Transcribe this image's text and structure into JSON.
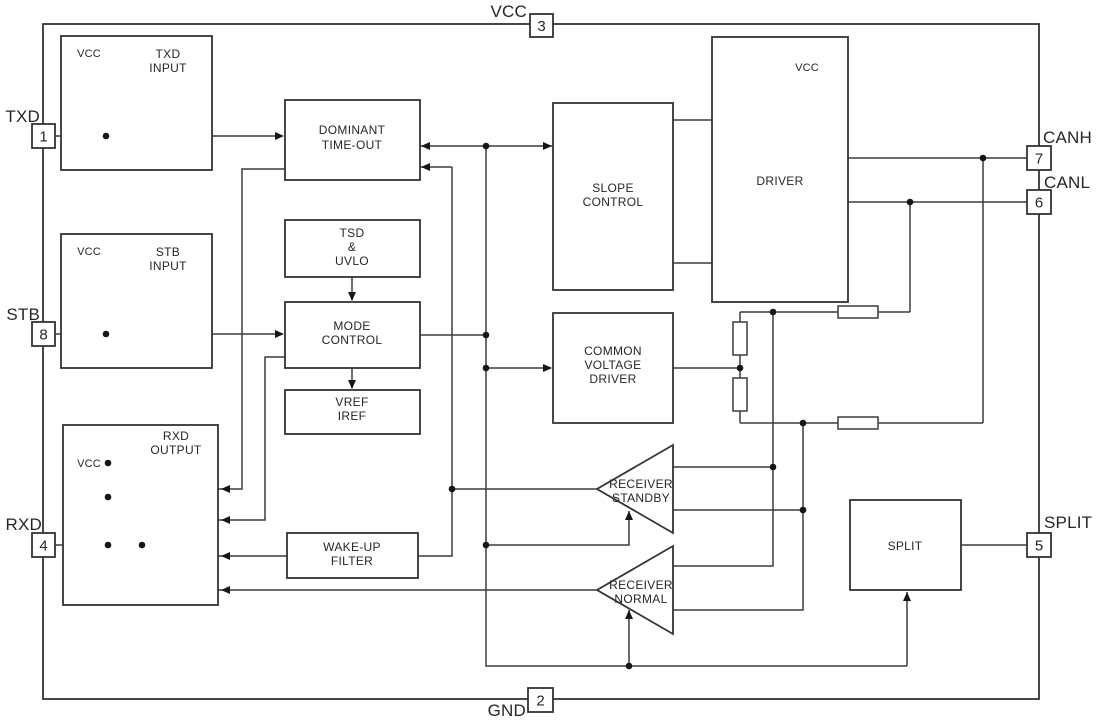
{
  "pins": {
    "txd": {
      "num": "1",
      "label": "TXD"
    },
    "gnd": {
      "num": "2",
      "label": "GND"
    },
    "vcc": {
      "num": "3",
      "label": "VCC"
    },
    "rxd": {
      "num": "4",
      "label": "RXD"
    },
    "split": {
      "num": "5",
      "label": "SPLIT"
    },
    "canl": {
      "num": "6",
      "label": "CANL"
    },
    "canh": {
      "num": "7",
      "label": "CANH"
    },
    "stb": {
      "num": "8",
      "label": "STB"
    }
  },
  "blocks": {
    "txd_input": [
      "TXD",
      "INPUT"
    ],
    "stb_input": [
      "STB",
      "INPUT"
    ],
    "rxd_output": [
      "RXD",
      "OUTPUT"
    ],
    "dominant_timeout": [
      "DOMINANT",
      "TIME-OUT"
    ],
    "tsd_uvlo": [
      "TSD",
      "&",
      "UVLO"
    ],
    "mode_control": [
      "MODE",
      "CONTROL"
    ],
    "vref_iref": [
      "VREF",
      "IREF"
    ],
    "wake_up_filter": [
      "WAKE-UP",
      "FILTER"
    ],
    "slope_control": [
      "SLOPE",
      "CONTROL"
    ],
    "common_voltage_driver": [
      "COMMON",
      "VOLTAGE",
      "DRIVER"
    ],
    "driver": "DRIVER",
    "receiver_standby": [
      "RECEIVER",
      "STANDBY"
    ],
    "receiver_normal": [
      "RECEIVER",
      "NORMAL"
    ],
    "split": "SPLIT"
  },
  "labels": {
    "vcc_internal": "VCC"
  },
  "colors": {
    "line": "#3c3c3c",
    "text": "#262626",
    "background": "#ffffff"
  }
}
